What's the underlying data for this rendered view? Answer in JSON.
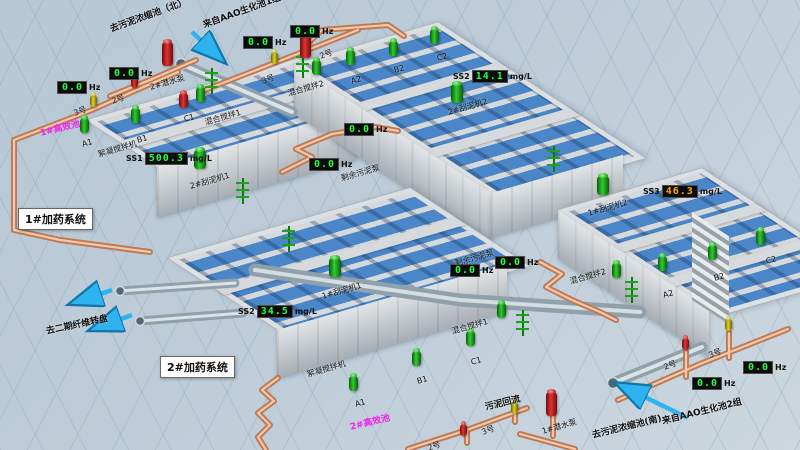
{
  "colors": {
    "copper_pipe": "#e09a76",
    "steel_pipe": "#b9c6cd",
    "water": "#4a86c8",
    "arrow": "#2fb3f0",
    "display_green": "#22ff44",
    "display_amber": "#ffaa00",
    "tank_label_magenta": "#ee22ee"
  },
  "system_boxes": {
    "sys1": "1#加药系统",
    "sys2": "2#加药系统"
  },
  "tank_names": {
    "t1": "1#高效池",
    "t2": "2#高效池"
  },
  "flow_labels": {
    "to_sludge_north": "去污泥浓缩池（北）",
    "from_aao_1": "来自AAO生化池1组",
    "to_fiber_disc": "去二期纤维转盘",
    "sludge_return": "污泥回流",
    "to_sludge_south": "去污泥浓缩池(南)",
    "from_aao_2": "来自AAO生化池2组"
  },
  "equipment": {
    "floc_mixer": "絮凝搅拌机",
    "mix_1": "混合搅拌1",
    "mix_2": "混合搅拌2",
    "a1": "A1",
    "b1": "B1",
    "c1": "C1",
    "a2": "A2",
    "b2": "B2",
    "c2": "C2",
    "pump_sub_1": "1#潜水泵",
    "pump_sub_2": "2#潜水泵",
    "pump_surplus": "剩余污泥泵",
    "scraper_11": "1#刮泥机1",
    "scraper_12": "1#刮泥机2",
    "scraper_21": "2#刮泥机1",
    "scraper_22": "2#刮泥机2",
    "valve_2": "2号",
    "valve_3": "3号"
  },
  "displays": {
    "hz_value": "0.0",
    "hz_unit": "Hz",
    "mg_unit": "mg/L",
    "ss1_label": "SS1",
    "ss1_value": "500.3",
    "ss2_label": "SS2",
    "ss2a_value": "14.1",
    "ss2b_value": "34.5",
    "ss3_label": "SS3",
    "ss3_value": "46.3"
  }
}
